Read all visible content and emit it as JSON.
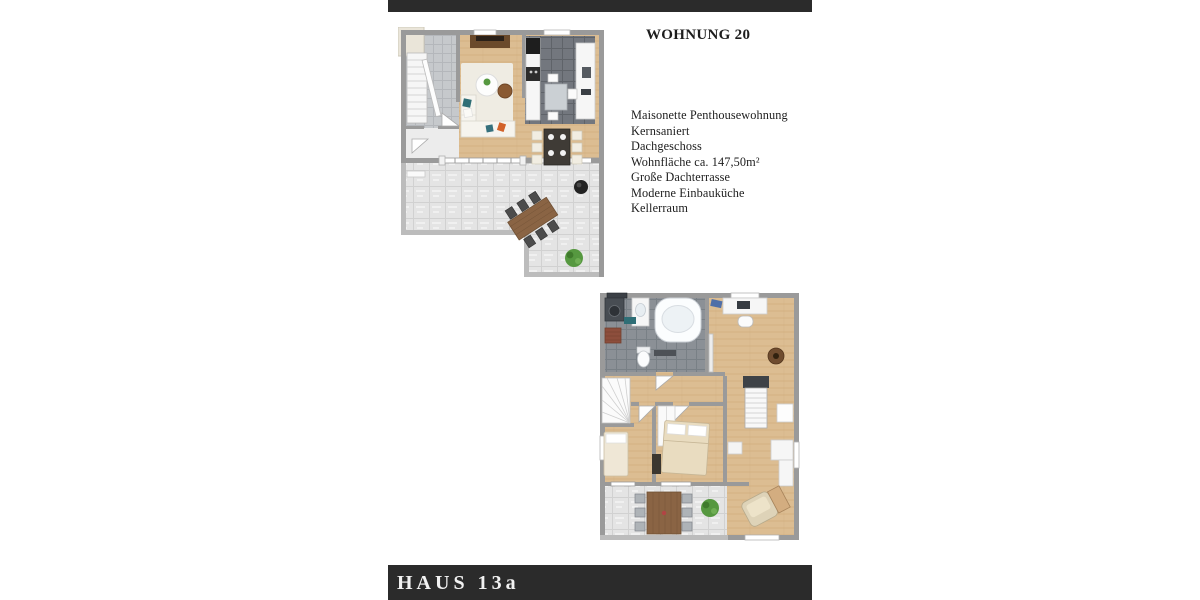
{
  "theme": {
    "bar": "#2b2b2b",
    "page_bg": "#ffffff",
    "ink": "#1d1d1d",
    "footer_ink": "#f2f2f2",
    "wall": "#9a9a9a",
    "wall_light": "#bcbcbc",
    "wood": "#dcbd92",
    "terrace_tile": "#e4e4e4",
    "kitchen_tile": "#73777e",
    "bath_tile": "#8b9096",
    "furn": "#f6f6f6",
    "teal": "#2f6e76",
    "orange": "#d2622a",
    "plant": "#569840",
    "table_wood": "#8a6444",
    "sideboard_brown": "#6b4a2b"
  },
  "header": {
    "title": "WOHNUNG 20"
  },
  "description": {
    "lines": [
      "Maisonette Penthousewohnung",
      "Kernsaniert",
      "Dachgeschoss",
      "Wohnfläche ca. 147,50m²",
      "Große Dachterrasse",
      "Moderne Einbauküche",
      "Kellerraum"
    ]
  },
  "floor_plans": [
    {
      "id": "penthouse-upper-level",
      "features": [
        "staircase",
        "living-room",
        "kitchen",
        "dining-table",
        "roof-terrace",
        "grill",
        "plant"
      ]
    },
    {
      "id": "penthouse-lower-level",
      "features": [
        "bathroom",
        "office",
        "bedrooms",
        "staircases",
        "terrace",
        "plant"
      ]
    }
  ],
  "footer": {
    "label": "HAUS 13a"
  }
}
